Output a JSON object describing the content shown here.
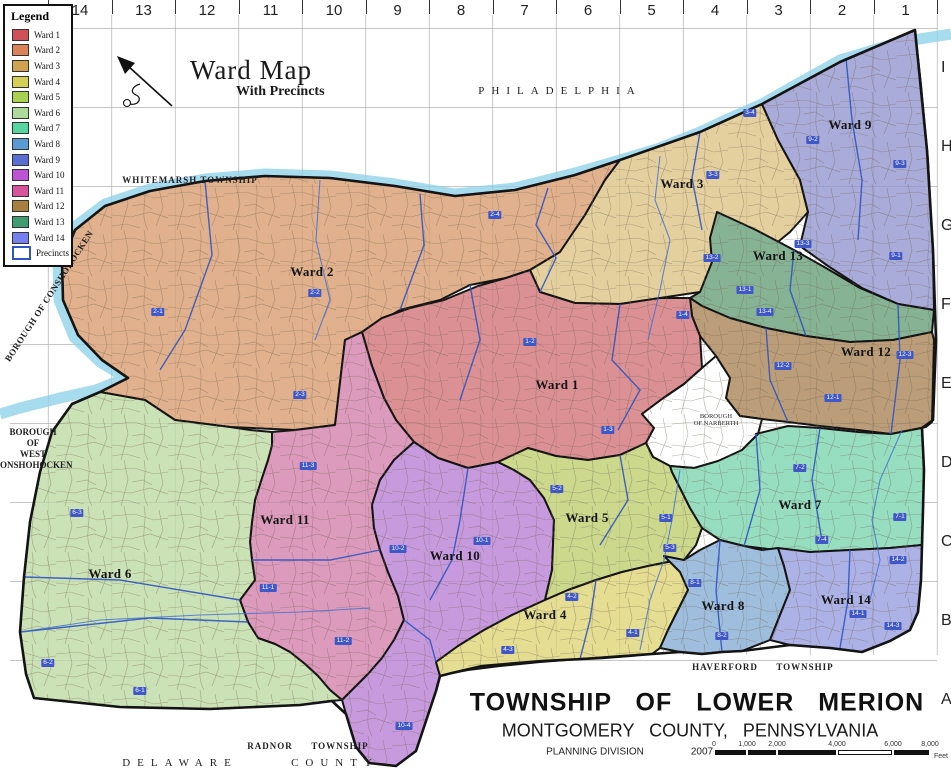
{
  "map_title": {
    "title": "Ward Map",
    "subtitle": "With Precincts"
  },
  "legend": {
    "title": "Legend",
    "precincts_label": "Precincts",
    "precinct_border": "#2f55c0"
  },
  "grid": {
    "columns": [
      "14",
      "13",
      "12",
      "11",
      "10",
      "9",
      "8",
      "7",
      "6",
      "5",
      "4",
      "3",
      "2",
      "1"
    ],
    "rows": [
      "I",
      "H",
      "G",
      "F",
      "E",
      "D",
      "C",
      "B",
      "A"
    ]
  },
  "colors": {
    "river": "#a6dcee",
    "boundary": "#141414",
    "precinct_line": "#2f55c0",
    "pill": "#3f57c7"
  },
  "wards": [
    {
      "name": "Ward 1",
      "legend_color": "#d05058",
      "map_color": "#db9094",
      "label_x": 557,
      "label_y": 385,
      "precincts": [
        {
          "t": "1-2",
          "x": 530,
          "y": 342
        },
        {
          "t": "1-4",
          "x": 683,
          "y": 315
        },
        {
          "t": "1-3",
          "x": 608,
          "y": 430
        }
      ]
    },
    {
      "name": "Ward 2",
      "legend_color": "#d98356",
      "map_color": "#e0b18c",
      "label_x": 312,
      "label_y": 272,
      "precincts": [
        {
          "t": "2-1",
          "x": 158,
          "y": 312
        },
        {
          "t": "2-2",
          "x": 315,
          "y": 293
        },
        {
          "t": "2-4",
          "x": 495,
          "y": 215
        },
        {
          "t": "2-3",
          "x": 300,
          "y": 395
        }
      ]
    },
    {
      "name": "Ward 3",
      "legend_color": "#d0a14e",
      "map_color": "#e4d09e",
      "label_x": 682,
      "label_y": 184,
      "precincts": [
        {
          "t": "3-3",
          "x": 713,
          "y": 175
        },
        {
          "t": "3-4",
          "x": 750,
          "y": 113
        }
      ]
    },
    {
      "name": "Ward 4",
      "legend_color": "#d6cf55",
      "map_color": "#e4dd92",
      "label_x": 545,
      "label_y": 615,
      "precincts": [
        {
          "t": "4-2",
          "x": 572,
          "y": 597
        },
        {
          "t": "4-1",
          "x": 633,
          "y": 633
        },
        {
          "t": "4-3",
          "x": 508,
          "y": 650
        }
      ]
    },
    {
      "name": "Ward 5",
      "legend_color": "#a8d152",
      "map_color": "#ccd98d",
      "label_x": 587,
      "label_y": 518,
      "precincts": [
        {
          "t": "5-2",
          "x": 557,
          "y": 489
        },
        {
          "t": "5-1",
          "x": 666,
          "y": 518
        },
        {
          "t": "5-3",
          "x": 670,
          "y": 548
        }
      ]
    },
    {
      "name": "Ward 6",
      "legend_color": "#aedb9c",
      "map_color": "#cbe2b6",
      "label_x": 110,
      "label_y": 574,
      "precincts": [
        {
          "t": "6-3",
          "x": 77,
          "y": 513
        },
        {
          "t": "6-2",
          "x": 48,
          "y": 663
        },
        {
          "t": "6-1",
          "x": 140,
          "y": 691
        }
      ]
    },
    {
      "name": "Ward 7",
      "legend_color": "#55d6a0",
      "map_color": "#97dec0",
      "label_x": 800,
      "label_y": 505,
      "precincts": [
        {
          "t": "7-2",
          "x": 800,
          "y": 468
        },
        {
          "t": "7-1",
          "x": 900,
          "y": 517
        },
        {
          "t": "7-4",
          "x": 822,
          "y": 540
        }
      ]
    },
    {
      "name": "Ward 8",
      "legend_color": "#5a9bd4",
      "map_color": "#9fbedd",
      "label_x": 723,
      "label_y": 606,
      "precincts": [
        {
          "t": "8-1",
          "x": 695,
          "y": 583
        },
        {
          "t": "8-2",
          "x": 722,
          "y": 636
        }
      ]
    },
    {
      "name": "Ward 9",
      "legend_color": "#5a6fd4",
      "map_color": "#a9abd9",
      "label_x": 850,
      "label_y": 125,
      "precincts": [
        {
          "t": "9-2",
          "x": 813,
          "y": 140
        },
        {
          "t": "9-3",
          "x": 900,
          "y": 164
        },
        {
          "t": "9-1",
          "x": 896,
          "y": 256
        }
      ]
    },
    {
      "name": "Ward 10",
      "legend_color": "#bd54d6",
      "map_color": "#c79add",
      "label_x": 455,
      "label_y": 556,
      "precincts": [
        {
          "t": "10-2",
          "x": 398,
          "y": 549
        },
        {
          "t": "10-1",
          "x": 482,
          "y": 541
        },
        {
          "t": "10-4",
          "x": 404,
          "y": 726
        }
      ]
    },
    {
      "name": "Ward 11",
      "legend_color": "#d6549c",
      "map_color": "#dc9abc",
      "label_x": 285,
      "label_y": 520,
      "precincts": [
        {
          "t": "11-3",
          "x": 308,
          "y": 466
        },
        {
          "t": "11-1",
          "x": 268,
          "y": 588
        },
        {
          "t": "11-2",
          "x": 343,
          "y": 641
        }
      ]
    },
    {
      "name": "Ward 12",
      "legend_color": "#a8803e",
      "map_color": "#bb9e79",
      "label_x": 866,
      "label_y": 352,
      "precincts": [
        {
          "t": "12-2",
          "x": 783,
          "y": 366
        },
        {
          "t": "12-1",
          "x": 833,
          "y": 398
        },
        {
          "t": "12-3",
          "x": 905,
          "y": 355
        }
      ]
    },
    {
      "name": "Ward 13",
      "legend_color": "#3e9c70",
      "map_color": "#86b394",
      "label_x": 778,
      "label_y": 256,
      "precincts": [
        {
          "t": "13-2",
          "x": 712,
          "y": 258
        },
        {
          "t": "13-3",
          "x": 803,
          "y": 244
        },
        {
          "t": "13-1",
          "x": 745,
          "y": 290
        },
        {
          "t": "13-4",
          "x": 765,
          "y": 312
        }
      ]
    },
    {
      "name": "Ward 14",
      "legend_color": "#7580ee",
      "map_color": "#adb2e6",
      "label_x": 846,
      "label_y": 600,
      "precincts": [
        {
          "t": "14-2",
          "x": 898,
          "y": 560
        },
        {
          "t": "14-1",
          "x": 858,
          "y": 614
        },
        {
          "t": "14-3",
          "x": 893,
          "y": 626
        }
      ]
    }
  ],
  "places": {
    "philadelphia": "PHILADELPHIA",
    "whitemarsh": "WHITEMARSH TOWNSHIP",
    "conshohocken": "BOROUGH OF CONSHOHOCKEN",
    "west_conshohocken": [
      "BOROUGH",
      "OF",
      "WEST",
      "CONSHOHOCKEN"
    ],
    "narberth": [
      "BOROUGH",
      "OF NARBERTH"
    ],
    "haverford": {
      "left": "HAVERFORD",
      "right": "TOWNSHIP"
    },
    "radnor": {
      "left": "RADNOR",
      "right": "TOWNSHIP"
    },
    "delaware": {
      "left": "DELAWARE",
      "right": "COUNTY"
    }
  },
  "title_block": {
    "line1": "TOWNSHIP OF LOWER MERION",
    "line2": "MONTGOMERY COUNTY, PENNSYLVANIA",
    "division": "PLANNING DIVISION",
    "year": "2007"
  },
  "scale_bar": {
    "ticks": [
      "0",
      "1,000",
      "2,000",
      "4,000",
      "6,000",
      "8,000"
    ],
    "unit": "Feet"
  }
}
